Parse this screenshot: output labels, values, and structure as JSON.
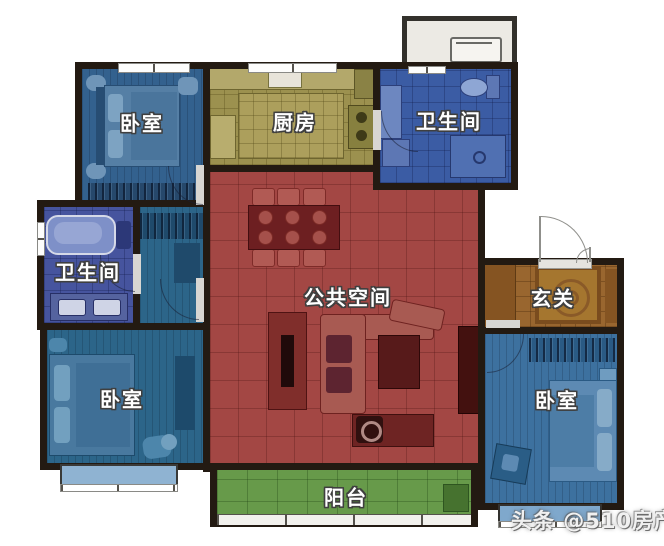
{
  "floorplan": {
    "type": "apartment-floor-plan",
    "wall_color": "#231a12",
    "background_color": "#ffffff",
    "rooms": [
      {
        "id": "bedroom-top-left",
        "label": "卧室",
        "color": "#33618e"
      },
      {
        "id": "kitchen",
        "label": "厨房",
        "color": "#9c914f"
      },
      {
        "id": "bathroom-top-right",
        "label": "卫生间",
        "color": "#3b5ca4"
      },
      {
        "id": "bathroom-left",
        "label": "卫生间",
        "color": "#46549e"
      },
      {
        "id": "public-space",
        "label": "公共空间",
        "color": "#a34744"
      },
      {
        "id": "entry-hall",
        "label": "玄关",
        "color": "#99662f"
      },
      {
        "id": "bedroom-bottom-left",
        "label": "卧室",
        "color": "#2c6589"
      },
      {
        "id": "bedroom-bottom-right",
        "label": "卧室",
        "color": "#3d719f"
      },
      {
        "id": "balcony",
        "label": "阳台",
        "color": "#679a4a"
      }
    ],
    "equipment_platform_color": "#eceae4",
    "bay_window_color": "#8fb3d2"
  },
  "watermark": {
    "text": "头条 @510房产网"
  }
}
